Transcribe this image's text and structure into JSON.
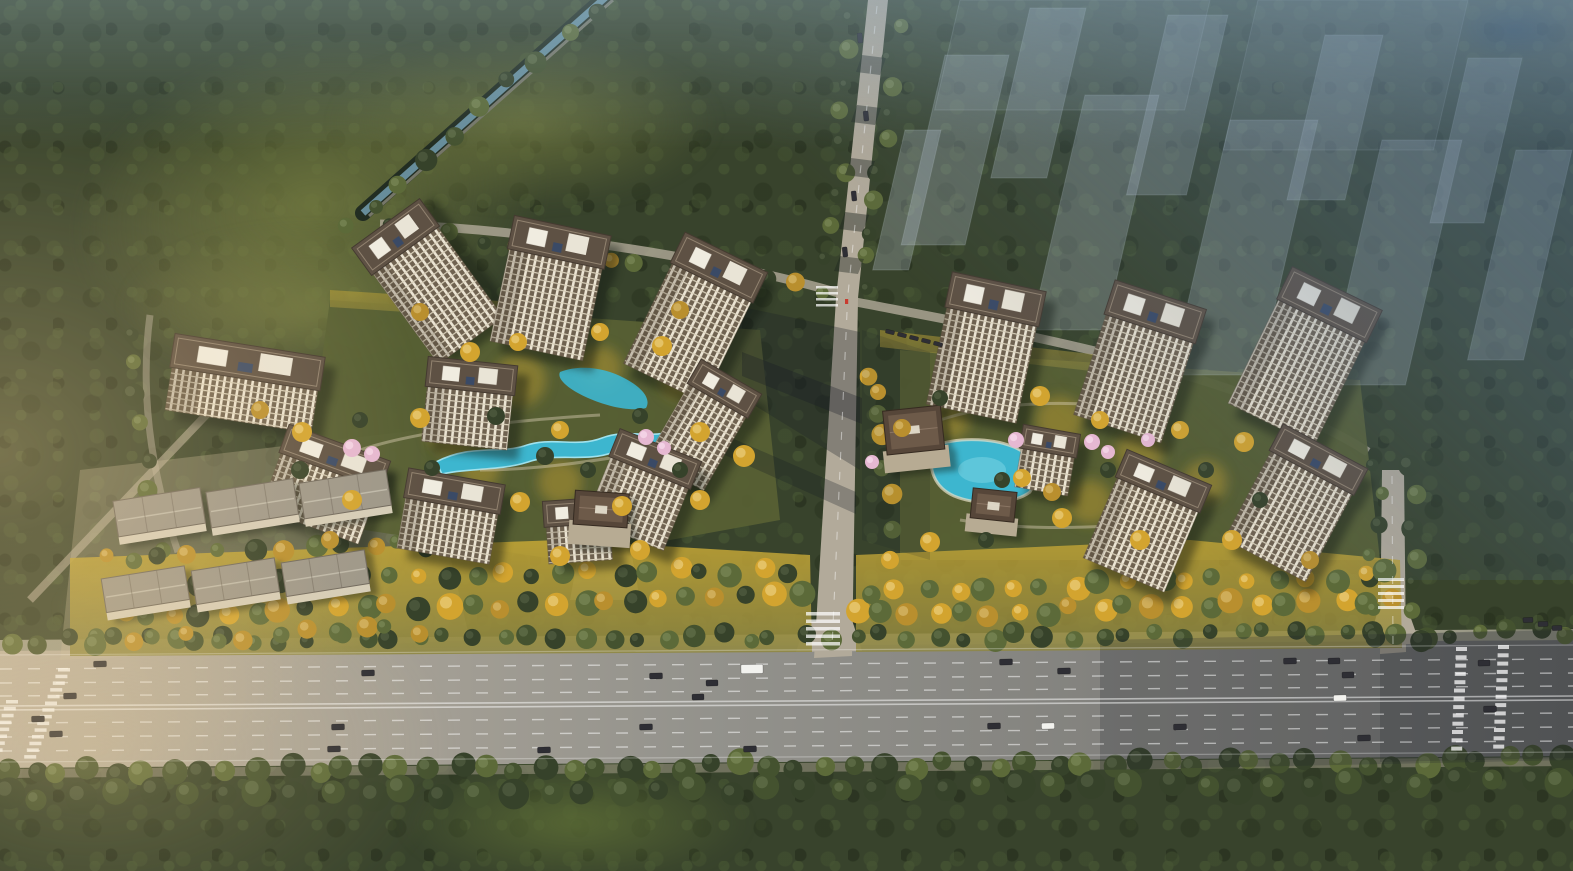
{
  "scene": {
    "type": "aerial-architectural-rendering",
    "palette": {
      "forest_base": "#38432c",
      "road_light": "#b2aa9a",
      "highway_left": "#bcb2a1",
      "highway_mid": "#93928c",
      "highway_right": "#6f6f6d",
      "water": "#3db6cf",
      "water_hi": "#8fdbe8",
      "roof": "#5e5144",
      "roof_edge": "#443a30",
      "facade_pier": "#ece5d4",
      "facade_window": "#6f6250",
      "facade_floor": "#d9d0ba",
      "club_roof": "#564639",
      "club_inner": "#6d5a49",
      "slab_roof": "#9d978a",
      "slab_edge": "#6f685d",
      "gold_grass_top": "#c3a535",
      "gold_grass_bot": "#8e8742",
      "tree_dark": "#44522f",
      "tree_olive": "#5c6a39",
      "tree_deep": "#36422a",
      "tree_gold": "#d3a42f",
      "tree_amber": "#b98f2e",
      "tree_blossom": "#e6b8d2",
      "haze_blue": "#526e90",
      "car_dark": "#2e2e34",
      "car_white": "#f2f2ee",
      "ghost_fill_rgb": "205,217,231",
      "entrance_marker_red": "#c93c30"
    },
    "buildings": [
      {
        "cx": 405,
        "cy": 250,
        "a": -36,
        "w": 80,
        "rh": 30,
        "fh": 112
      },
      {
        "cx": 556,
        "cy": 258,
        "a": 12,
        "w": 95,
        "rh": 30,
        "fh": 95
      },
      {
        "cx": 712,
        "cy": 282,
        "a": 26,
        "w": 88,
        "rh": 30,
        "fh": 112
      },
      {
        "cx": 245,
        "cy": 378,
        "a": 9,
        "w": 148,
        "rh": 30,
        "fh": 44
      },
      {
        "cx": 470,
        "cy": 390,
        "a": 6,
        "w": 86,
        "rh": 26,
        "fh": 56
      },
      {
        "cx": 718,
        "cy": 400,
        "a": 30,
        "w": 66,
        "rh": 24,
        "fh": 86
      },
      {
        "cx": 330,
        "cy": 470,
        "a": 20,
        "w": 104,
        "rh": 26,
        "fh": 60
      },
      {
        "cx": 650,
        "cy": 472,
        "a": 22,
        "w": 84,
        "rh": 26,
        "fh": 68
      },
      {
        "cx": 452,
        "cy": 505,
        "a": 10,
        "w": 94,
        "rh": 26,
        "fh": 52
      },
      {
        "cx": 578,
        "cy": 524,
        "a": -4,
        "w": 64,
        "rh": 22,
        "fh": 38
      },
      {
        "cx": 992,
        "cy": 316,
        "a": 12,
        "w": 92,
        "rh": 32,
        "fh": 100
      },
      {
        "cx": 1150,
        "cy": 328,
        "a": 18,
        "w": 92,
        "rh": 32,
        "fh": 106
      },
      {
        "cx": 1322,
        "cy": 320,
        "a": 26,
        "w": 96,
        "rh": 32,
        "fh": 116
      },
      {
        "cx": 1158,
        "cy": 494,
        "a": 23,
        "w": 88,
        "rh": 26,
        "fh": 88
      },
      {
        "cx": 1312,
        "cy": 472,
        "a": 28,
        "w": 92,
        "rh": 26,
        "fh": 100
      },
      {
        "cx": 1048,
        "cy": 452,
        "a": 10,
        "w": 54,
        "rh": 20,
        "fh": 40
      },
      {
        "cx": 600,
        "cy": 526,
        "a": 4,
        "w": 54,
        "rh": 34,
        "fh": 18,
        "t": "club"
      },
      {
        "cx": 916,
        "cy": 452,
        "a": -6,
        "w": 58,
        "rh": 44,
        "fh": 16,
        "t": "club"
      },
      {
        "cx": 992,
        "cy": 520,
        "a": 6,
        "w": 44,
        "rh": 30,
        "fh": 12,
        "t": "club"
      },
      {
        "cx": 162,
        "cy": 530,
        "a": -9,
        "w": 88,
        "rh": 36,
        "fh": 8,
        "t": "slab"
      },
      {
        "cx": 255,
        "cy": 521,
        "a": -9,
        "w": 88,
        "rh": 36,
        "fh": 8,
        "t": "slab"
      },
      {
        "cx": 348,
        "cy": 512,
        "a": -9,
        "w": 88,
        "rh": 36,
        "fh": 8,
        "t": "slab"
      },
      {
        "cx": 148,
        "cy": 606,
        "a": -9,
        "w": 84,
        "rh": 34,
        "fh": 8,
        "t": "slab"
      },
      {
        "cx": 238,
        "cy": 598,
        "a": -9,
        "w": 84,
        "rh": 34,
        "fh": 8,
        "t": "slab"
      },
      {
        "cx": 328,
        "cy": 590,
        "a": -9,
        "w": 84,
        "rh": 34,
        "fh": 8,
        "t": "slab"
      }
    ],
    "ghost_buildings": [
      {
        "x": 960,
        "y": 0,
        "w": 250,
        "h": 110,
        "o": 0.1
      },
      {
        "x": 1258,
        "y": 0,
        "w": 210,
        "h": 150,
        "o": 0.1
      },
      {
        "x": 945,
        "y": 55,
        "w": 64,
        "h": 190
      },
      {
        "x": 1030,
        "y": 8,
        "w": 56,
        "h": 170
      },
      {
        "x": 1085,
        "y": 95,
        "w": 74,
        "h": 235
      },
      {
        "x": 1168,
        "y": 15,
        "w": 60,
        "h": 180
      },
      {
        "x": 1230,
        "y": 120,
        "w": 88,
        "h": 255
      },
      {
        "x": 1325,
        "y": 35,
        "w": 58,
        "h": 165
      },
      {
        "x": 1382,
        "y": 140,
        "w": 80,
        "h": 245
      },
      {
        "x": 1468,
        "y": 58,
        "w": 54,
        "h": 165
      },
      {
        "x": 1516,
        "y": 150,
        "w": 56,
        "h": 210
      },
      {
        "x": 905,
        "y": 130,
        "w": 36,
        "h": 140
      }
    ],
    "tree_rows": [
      [
        8,
        641,
        1566,
        633,
        58,
        9,
        [
          "g2",
          "g1",
          "g3"
        ]
      ],
      [
        4,
        772,
        1566,
        760,
        56,
        11,
        [
          "g1",
          "g3",
          "g2"
        ]
      ],
      [
        120,
        614,
        800,
        598,
        26,
        11,
        [
          "y1",
          "g2",
          "y2",
          "g3"
        ]
      ],
      [
        858,
        616,
        1395,
        600,
        21,
        11,
        [
          "y1",
          "g2",
          "y2"
        ]
      ],
      [
        856,
        22,
        826,
        288,
        10,
        8,
        [
          "g3",
          "g2"
        ]
      ],
      [
        896,
        24,
        868,
        288,
        10,
        8,
        [
          "g2",
          "g3"
        ]
      ],
      [
        598,
        8,
        372,
        206,
        9,
        9,
        [
          "g3",
          "g2",
          "g1"
        ]
      ],
      [
        352,
        222,
        800,
        286,
        15,
        8,
        [
          "g2",
          "g3",
          "y2"
        ]
      ],
      [
        1376,
        470,
        1372,
        640,
        7,
        8,
        [
          "g3",
          "g2"
        ]
      ],
      [
        1412,
        470,
        1416,
        640,
        7,
        9,
        [
          "g3",
          "g2"
        ]
      ],
      [
        128,
        330,
        162,
        552,
        8,
        9,
        [
          "g3",
          "g2"
        ]
      ],
      [
        104,
        560,
        430,
        545,
        12,
        9,
        [
          "y2",
          "g2",
          "g3"
        ]
      ],
      [
        100,
        640,
        420,
        630,
        12,
        9,
        [
          "g2",
          "y2"
        ]
      ],
      [
        6,
        796,
        1566,
        782,
        44,
        13,
        [
          "g3",
          "g1"
        ]
      ],
      [
        872,
        380,
        896,
        556,
        7,
        9,
        [
          "y1",
          "g2"
        ]
      ],
      [
        140,
        585,
        790,
        570,
        24,
        10,
        [
          "g2",
          "y1",
          "g3"
        ]
      ],
      [
        870,
        590,
        1390,
        575,
        19,
        10,
        [
          "g2",
          "y1"
        ]
      ]
    ],
    "trees": [
      [
        352,
        448,
        9,
        "p"
      ],
      [
        372,
        454,
        8,
        "p"
      ],
      [
        646,
        437,
        8,
        "p"
      ],
      [
        664,
        448,
        7,
        "p"
      ],
      [
        1016,
        440,
        8,
        "p"
      ],
      [
        1092,
        442,
        8,
        "p"
      ],
      [
        1108,
        452,
        7,
        "p"
      ],
      [
        1148,
        440,
        7,
        "p"
      ],
      [
        872,
        462,
        7,
        "p"
      ],
      [
        470,
        352,
        10,
        "y1"
      ],
      [
        518,
        342,
        9,
        "y1"
      ],
      [
        600,
        332,
        9,
        "y1"
      ],
      [
        662,
        346,
        10,
        "y1"
      ],
      [
        420,
        418,
        10,
        "y1"
      ],
      [
        560,
        430,
        9,
        "y1"
      ],
      [
        700,
        432,
        10,
        "y1"
      ],
      [
        744,
        456,
        11,
        "y1"
      ],
      [
        302,
        432,
        10,
        "y1"
      ],
      [
        352,
        500,
        10,
        "y1"
      ],
      [
        520,
        502,
        10,
        "y1"
      ],
      [
        622,
        506,
        10,
        "y1"
      ],
      [
        700,
        500,
        10,
        "y1"
      ],
      [
        420,
        312,
        9,
        "y2"
      ],
      [
        680,
        310,
        9,
        "y2"
      ],
      [
        260,
        410,
        9,
        "y2"
      ],
      [
        560,
        556,
        10,
        "y1"
      ],
      [
        640,
        550,
        10,
        "y1"
      ],
      [
        330,
        540,
        9,
        "y2"
      ],
      [
        496,
        416,
        9,
        "g3"
      ],
      [
        545,
        456,
        9,
        "g3"
      ],
      [
        588,
        470,
        8,
        "g3"
      ],
      [
        640,
        416,
        8,
        "g3"
      ],
      [
        432,
        468,
        8,
        "g3"
      ],
      [
        360,
        420,
        8,
        "g3"
      ],
      [
        300,
        470,
        9,
        "g3"
      ],
      [
        680,
        470,
        8,
        "g3"
      ],
      [
        1040,
        396,
        10,
        "y1"
      ],
      [
        1100,
        420,
        9,
        "y1"
      ],
      [
        1180,
        430,
        9,
        "y1"
      ],
      [
        1244,
        442,
        10,
        "y1"
      ],
      [
        1062,
        518,
        10,
        "y1"
      ],
      [
        1140,
        540,
        10,
        "y1"
      ],
      [
        1232,
        540,
        10,
        "y1"
      ],
      [
        930,
        542,
        10,
        "y1"
      ],
      [
        902,
        428,
        9,
        "y2"
      ],
      [
        1022,
        478,
        9,
        "y1"
      ],
      [
        1052,
        492,
        9,
        "y2"
      ],
      [
        878,
        392,
        8,
        "y2"
      ],
      [
        890,
        560,
        9,
        "y1"
      ],
      [
        1310,
        560,
        9,
        "y2"
      ],
      [
        1002,
        480,
        8,
        "g3"
      ],
      [
        1108,
        470,
        8,
        "g3"
      ],
      [
        1206,
        470,
        8,
        "g3"
      ],
      [
        986,
        540,
        8,
        "g3"
      ],
      [
        1260,
        500,
        8,
        "g3"
      ],
      [
        940,
        398,
        8,
        "g3"
      ]
    ],
    "grass_patches": [
      [
        520,
        380,
        26
      ],
      [
        600,
        368,
        22
      ],
      [
        452,
        432,
        24
      ],
      [
        640,
        470,
        22
      ],
      [
        560,
        482,
        22
      ],
      [
        480,
        470,
        20
      ],
      [
        1060,
        420,
        24
      ],
      [
        1140,
        452,
        24
      ],
      [
        1090,
        502,
        22
      ],
      [
        1205,
        482,
        22
      ],
      [
        680,
        380,
        20
      ],
      [
        950,
        420,
        20
      ]
    ],
    "cars": [
      [
        100,
        664,
        13,
        6,
        "dk",
        -1
      ],
      [
        368,
        673,
        13,
        6,
        "dk",
        -1
      ],
      [
        656,
        676,
        13,
        6,
        "dk",
        -1
      ],
      [
        712,
        683,
        12,
        6,
        "dk",
        -1
      ],
      [
        698,
        697,
        12,
        6,
        "dk",
        -1
      ],
      [
        752,
        669,
        22,
        9,
        "wt",
        -1
      ],
      [
        1006,
        662,
        13,
        6,
        "dk",
        -1
      ],
      [
        1064,
        671,
        13,
        6,
        "dk",
        -1
      ],
      [
        1290,
        661,
        13,
        6,
        "dk",
        -1
      ],
      [
        1348,
        675,
        12,
        6,
        "dk",
        -1
      ],
      [
        1484,
        663,
        12,
        6,
        "dk",
        -1
      ],
      [
        70,
        696,
        13,
        6,
        "dk",
        -1
      ],
      [
        38,
        719,
        13,
        6,
        "dk",
        -1
      ],
      [
        56,
        734,
        13,
        6,
        "dk",
        -1
      ],
      [
        338,
        727,
        13,
        6,
        "dk",
        -1
      ],
      [
        334,
        749,
        13,
        6,
        "dk",
        -1
      ],
      [
        544,
        750,
        13,
        6,
        "dk",
        -1
      ],
      [
        646,
        727,
        13,
        6,
        "dk",
        -1
      ],
      [
        750,
        749,
        13,
        6,
        "dk",
        -1
      ],
      [
        994,
        726,
        13,
        6,
        "dk",
        -1
      ],
      [
        1048,
        726,
        13,
        6,
        "wt",
        -1
      ],
      [
        1180,
        727,
        13,
        6,
        "dk",
        -1
      ],
      [
        1364,
        738,
        13,
        6,
        "dk",
        -1
      ],
      [
        1340,
        698,
        13,
        6,
        "wt",
        -1
      ],
      [
        1490,
        709,
        13,
        6,
        "dk",
        -1
      ],
      [
        1334,
        661,
        12,
        6,
        "dk",
        -1
      ],
      [
        1528,
        620,
        10,
        5,
        "dk",
        -2
      ],
      [
        1543,
        624,
        10,
        5,
        "dk",
        -2
      ],
      [
        1557,
        628,
        10,
        5,
        "dk",
        -2
      ],
      [
        860,
        38,
        5,
        10,
        "dk",
        -6
      ],
      [
        866,
        116,
        5,
        10,
        "dk",
        -6
      ],
      [
        854,
        196,
        5,
        10,
        "dk",
        -6
      ],
      [
        845,
        252,
        5,
        10,
        "dk",
        -6
      ],
      [
        890,
        332,
        9,
        4,
        "dk",
        14
      ],
      [
        902,
        335,
        9,
        4,
        "dk",
        14
      ],
      [
        914,
        338,
        9,
        4,
        "dk",
        14
      ],
      [
        926,
        341,
        9,
        4,
        "dk",
        14
      ],
      [
        938,
        344,
        9,
        4,
        "dk",
        14
      ]
    ],
    "crosswalks": [
      [
        58,
        668,
        14,
        12,
        3.5,
        3.2,
        -2.6
      ],
      [
        6,
        700,
        8,
        12,
        3.5,
        3.4,
        -2.2
      ],
      [
        1456,
        647,
        13,
        11,
        4,
        4.3,
        -0.4
      ],
      [
        1498,
        645,
        13,
        11,
        4,
        4.3,
        -0.4
      ],
      [
        806,
        612,
        5,
        34,
        3.5,
        4,
        0
      ],
      [
        1378,
        578,
        5,
        26,
        3,
        4,
        0
      ],
      [
        816,
        286,
        4,
        22,
        2.5,
        3.5,
        0
      ]
    ]
  }
}
